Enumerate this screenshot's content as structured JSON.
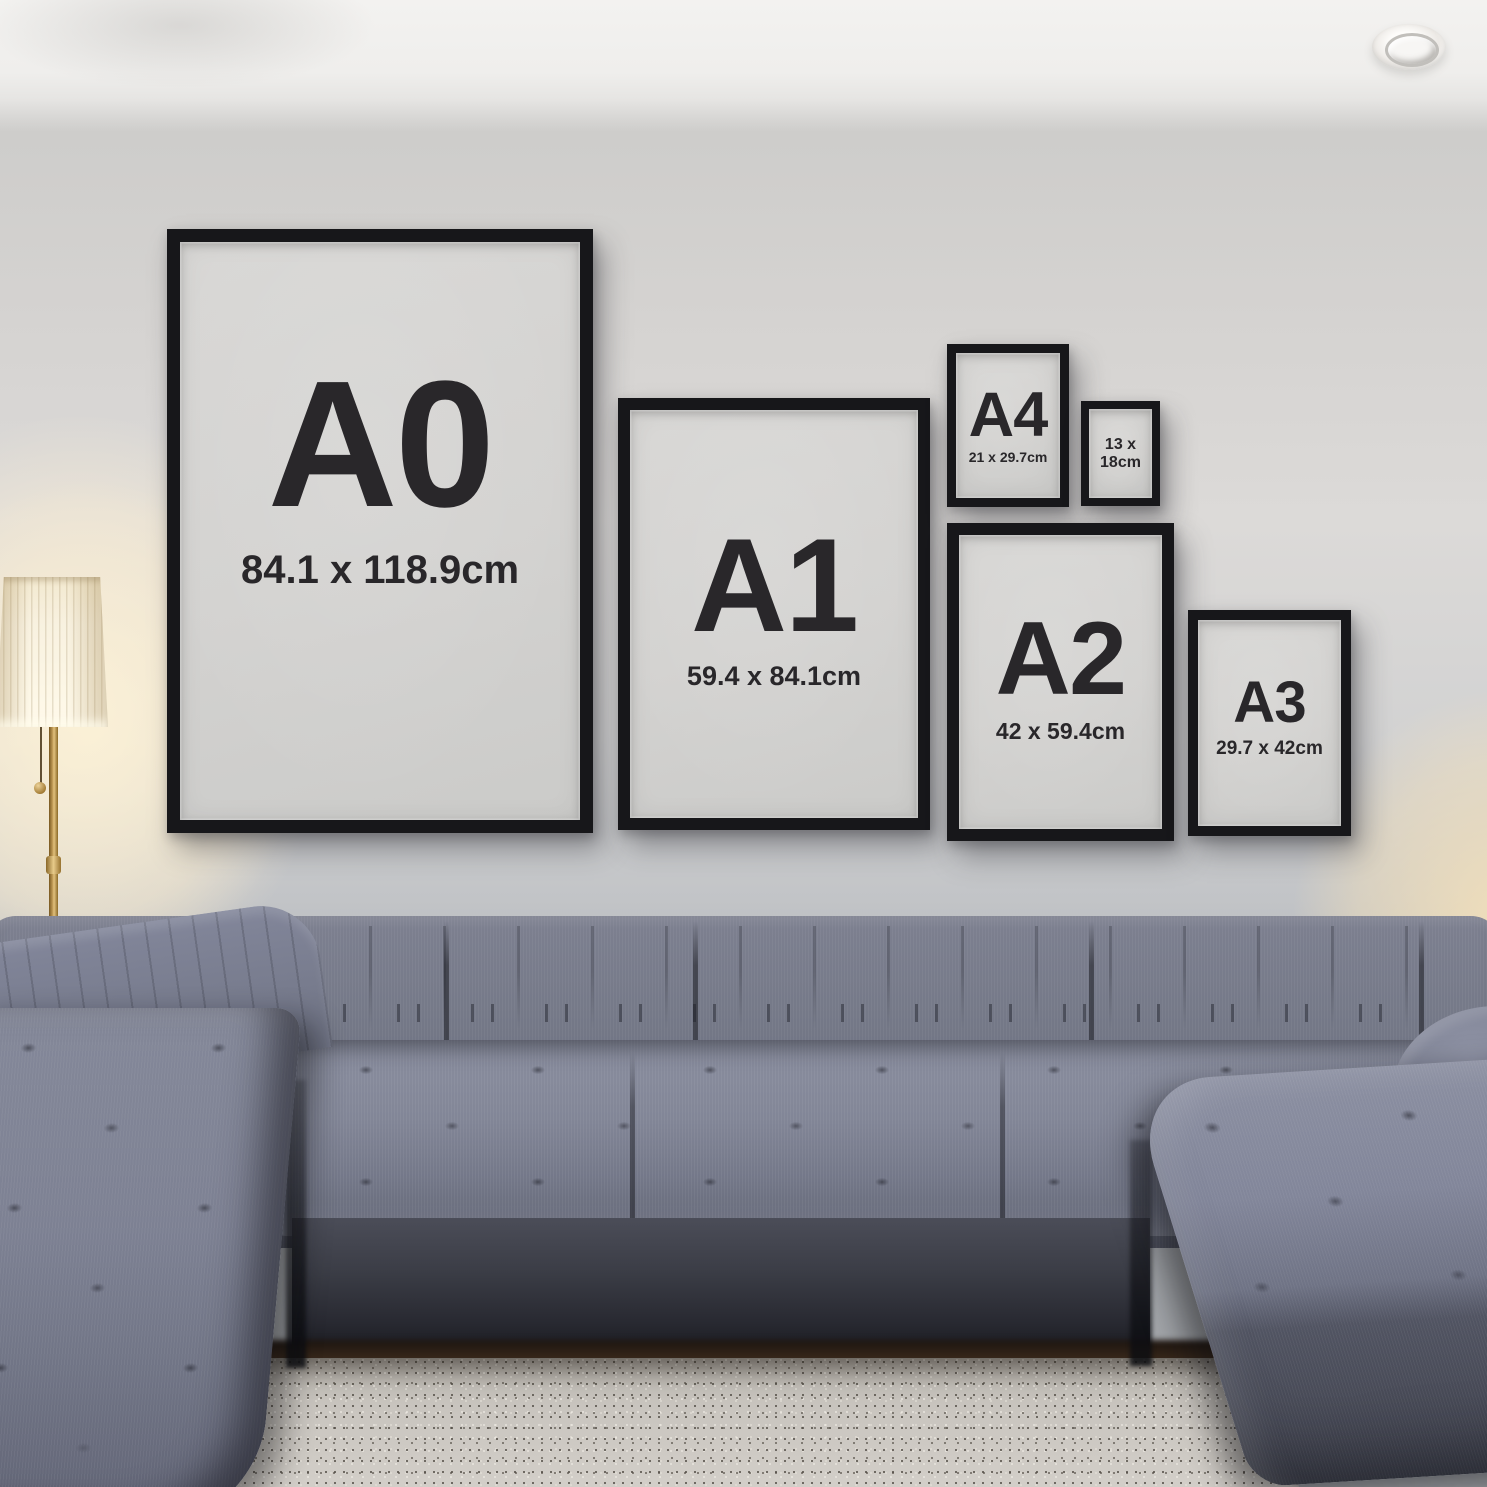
{
  "frames": [
    {
      "name": "A0",
      "label": "A0",
      "dimensions": "84.1 x 118.9cm"
    },
    {
      "name": "A1",
      "label": "A1",
      "dimensions": "59.4 x 84.1cm"
    },
    {
      "name": "A4",
      "label": "A4",
      "dimensions": "21 x 29.7cm"
    },
    {
      "name": "13x18",
      "dimensions": "13 x 18cm",
      "dimensions_lines": [
        "13 x",
        "18cm"
      ]
    },
    {
      "name": "A2",
      "label": "A2",
      "dimensions": "42 x 59.4cm"
    },
    {
      "name": "A3",
      "label": "A3",
      "dimensions": "29.7 x 42cm"
    }
  ],
  "colors": {
    "frame-black": "#17171a",
    "paper": "#d3d2d0",
    "ink": "#29272a",
    "wall-mid": "#d6d4d2",
    "ceiling": "#f3f2f0",
    "sofa-light": "#878b9c",
    "sofa-mid": "#6e7283",
    "sofa-dark": "#4a4c57",
    "rug-base": "#c9c5bf",
    "shade-cream": "#f6eedb",
    "brass": "#c29a55",
    "glow-warm": "#ffeecd"
  }
}
